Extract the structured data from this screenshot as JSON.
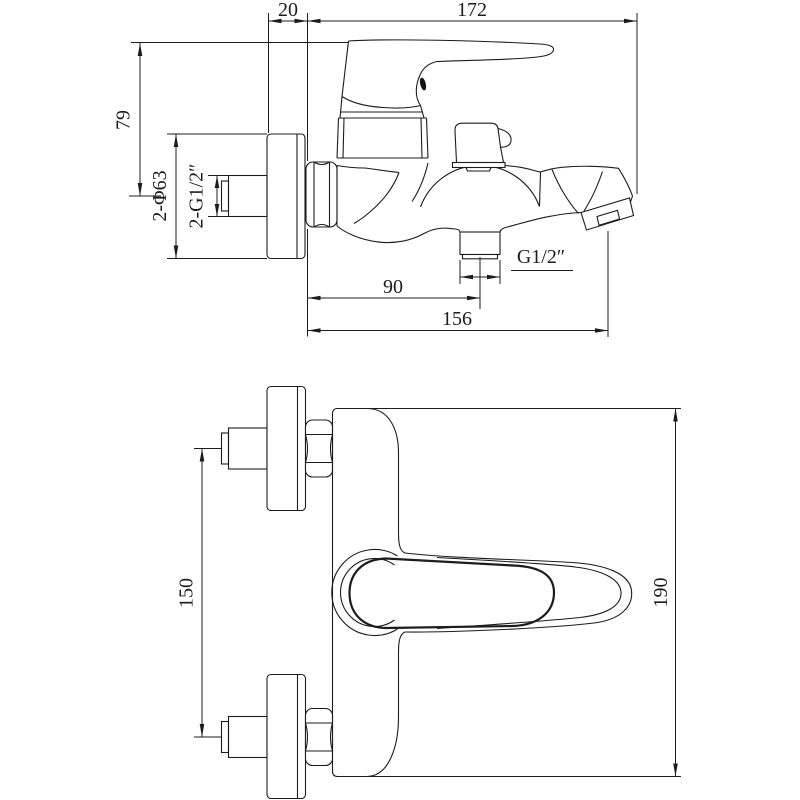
{
  "drawing": {
    "type": "technical-drawing",
    "subject": "wall-mounted single-lever bath mixer faucet, two orthographic views",
    "background_color": "#ffffff",
    "line_color": "#1c1c1c"
  },
  "dims": {
    "d20": "20",
    "d172": "172",
    "d79": "79",
    "d2phi63": "2-Φ63",
    "d2g12": "2-G1/2″",
    "d90": "90",
    "d156": "156",
    "dg12": "G1/2″",
    "d150": "150",
    "d190": "190"
  },
  "dimensions_mm": {
    "wall_offset": 20,
    "overall_length": 172,
    "handle_height": 79,
    "escutcheon_diameter": "2 x 63",
    "inlet_thread": "2 x G1/2 inch",
    "outlet_center_offset": 90,
    "outlet_overall": 156,
    "shower_outlet_thread": "G1/2 inch",
    "inlet_spacing": 150,
    "overall_width": 190
  }
}
